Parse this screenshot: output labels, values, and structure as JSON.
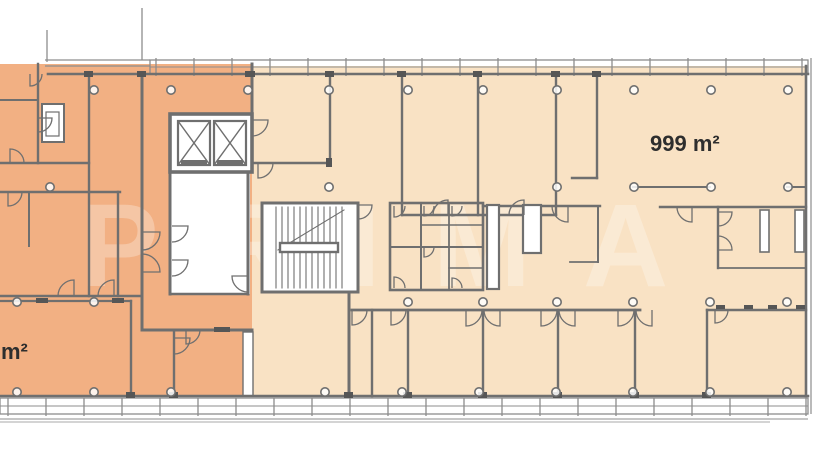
{
  "plan": {
    "unit_right": {
      "area_label": "999 m²"
    },
    "unit_left": {
      "area_label": "m²"
    },
    "watermark": "PRIMA",
    "colors": {
      "unit_left_fill": "#f2b083",
      "unit_right_fill": "#f9e2c4",
      "wall": "#6f6f6f",
      "facade": "#8d8d8d",
      "label_text": "#2e2e2e",
      "background": "#ffffff"
    }
  }
}
